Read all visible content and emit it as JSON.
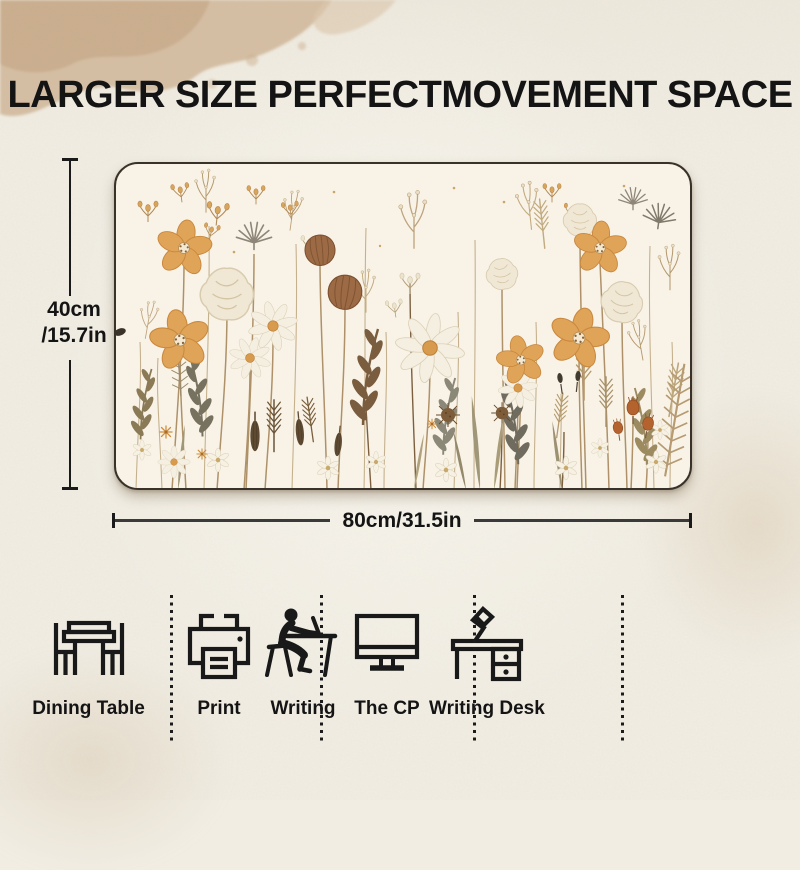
{
  "title": "LARGER SIZE PERFECTMOVEMENT SPACE",
  "product": {
    "artwork_alt": "Watercolor wildflower meadow desk mat"
  },
  "dimensions": {
    "height_line1": "40cm",
    "height_line2": "/15.7in",
    "width": "80cm/31.5in"
  },
  "features": [
    {
      "icon": "dining-table-icon",
      "label": "Dining Table"
    },
    {
      "icon": "printer-icon",
      "label": "Print"
    },
    {
      "icon": "writing-person-icon",
      "label": "Writing"
    },
    {
      "icon": "computer-monitor-icon",
      "label": "The CP"
    },
    {
      "icon": "writing-desk-icon",
      "label": "Writing Desk"
    }
  ],
  "palette": {
    "paper_background": "#f1ede3",
    "watercolor_wash": "#d2b99c",
    "mat_background": "#f9f3e7",
    "ink": "#161616",
    "flower_orange": "#e0a458",
    "flower_white": "#f5efe1",
    "seed_pod_brown": "#9c6b45",
    "stem_tan": "#aa8c62",
    "foliage_grey": "#77725f",
    "sage_green": "#a09678",
    "rust_accent": "#b4622e"
  }
}
